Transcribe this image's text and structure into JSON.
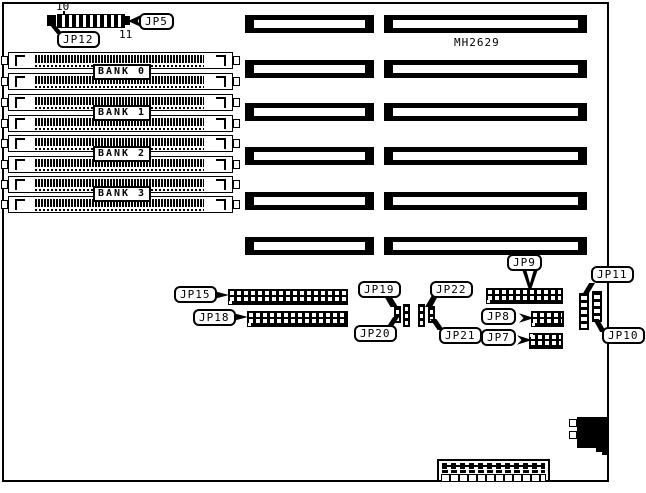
{
  "diagram": {
    "model": "MH2629",
    "pin_numbers": {
      "pin10": "10",
      "pin11": "11"
    },
    "memory_banks": [
      "BANK 0",
      "BANK 1",
      "BANK 2",
      "BANK 3"
    ],
    "jumpers": {
      "jp5": "JP5",
      "jp7": "JP7",
      "jp8": "JP8",
      "jp9": "JP9",
      "jp10": "JP10",
      "jp11": "JP11",
      "jp12": "JP12",
      "jp15": "JP15",
      "jp18": "JP18",
      "jp19": "JP19",
      "jp20": "JP20",
      "jp21": "JP21",
      "jp22": "JP22"
    },
    "colors": {
      "line": "#000000",
      "background": "#ffffff"
    }
  }
}
